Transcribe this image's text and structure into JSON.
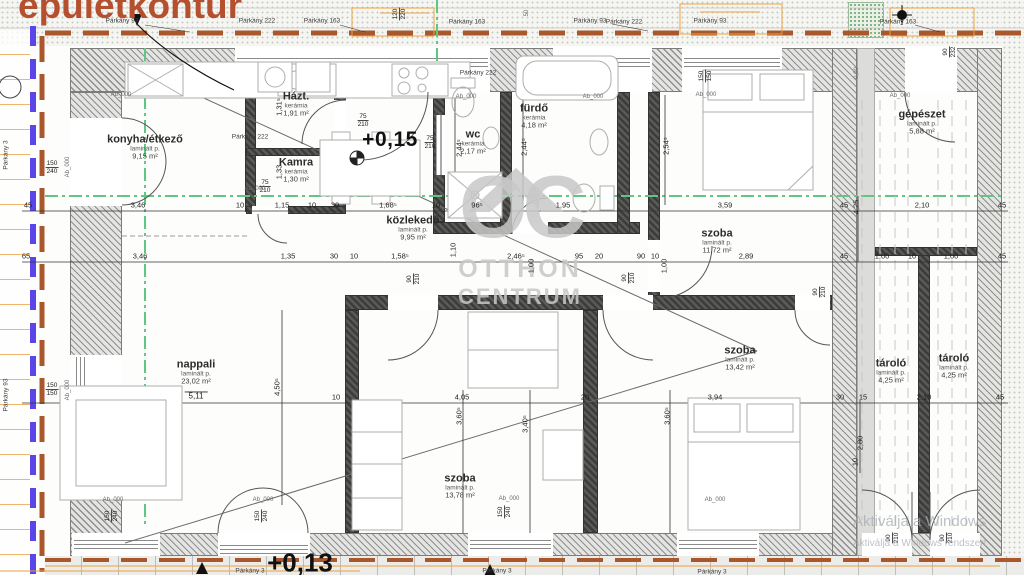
{
  "title": "épületkontúr",
  "watermark": {
    "logo": "OC",
    "line1": "OTTHON",
    "line2": "CENTRUM"
  },
  "windows_watermark": {
    "line1": "Aktiválja a Windows",
    "line2": "Aktiválja a Windows rendszert"
  },
  "colors": {
    "title_red": "#b5502f",
    "contour_brown": "#a9572b",
    "guide_blue": "#5a46e8",
    "guide_green": "#5ec784",
    "construction_orange": "#eba23e",
    "watermark_gray": "#c8c8c8"
  },
  "rooms": [
    {
      "name": "konyha/étkező",
      "mat": "laminált p.",
      "area": "9,15 m²",
      "extra": "",
      "x": 145,
      "y": 147
    },
    {
      "name": "Házt.",
      "mat": "kerámia",
      "area": "1,91 m²",
      "extra": "",
      "x": 296,
      "y": 104
    },
    {
      "name": "Kamra",
      "mat": "kerámia",
      "area": "1,30 m²",
      "extra": "",
      "x": 296,
      "y": 170
    },
    {
      "name": "wc",
      "mat": "kerámia",
      "area": "2,17 m²",
      "extra": "",
      "x": 473,
      "y": 142
    },
    {
      "name": "fürdő",
      "mat": "kerámia",
      "area": "4,18 m²",
      "extra": "",
      "x": 534,
      "y": 116
    },
    {
      "name": "közlekedő",
      "mat": "laminált p.",
      "area": "9,95 m²",
      "extra": "",
      "x": 413,
      "y": 228
    },
    {
      "name": "szoba",
      "mat": "laminált p.",
      "area": "11,72 m²",
      "extra": "",
      "x": 717,
      "y": 241
    },
    {
      "name": "nappali",
      "mat": "laminált p.",
      "area": "23,02 m²",
      "extra": "5,11",
      "x": 196,
      "y": 381
    },
    {
      "name": "szoba",
      "mat": "laminált p.",
      "area": "13,42 m²",
      "extra": "",
      "x": 740,
      "y": 358
    },
    {
      "name": "szoba",
      "mat": "laminált p.",
      "area": "13,78 m²",
      "extra": "",
      "x": 460,
      "y": 486
    },
    {
      "name": "gépészet",
      "mat": "laminált p.",
      "area": "5,88 m²",
      "extra": "",
      "x": 922,
      "y": 122
    },
    {
      "name": "tároló",
      "mat": "laminált p.",
      "area": "4,25 m²",
      "extra": "",
      "x": 891,
      "y": 371
    },
    {
      "name": "tároló",
      "mat": "laminált p.",
      "area": "4,25 m²",
      "extra": "",
      "x": 954,
      "y": 366
    }
  ],
  "labels": [
    {
      "t": "+0,15",
      "x": 390,
      "y": 140,
      "c": "lv"
    },
    {
      "t": "+0,13",
      "x": 300,
      "y": 563,
      "c": "lv2"
    },
    {
      "t": "45",
      "x": 28,
      "y": 205,
      "c": "d"
    },
    {
      "t": "3,46",
      "x": 138,
      "y": 205,
      "c": "d"
    },
    {
      "t": "10",
      "x": 240,
      "y": 205,
      "c": "d"
    },
    {
      "t": "1,15",
      "x": 282,
      "y": 205,
      "c": "d"
    },
    {
      "t": "10",
      "x": 312,
      "y": 205,
      "c": "d"
    },
    {
      "t": "30",
      "x": 335,
      "y": 205,
      "c": "d"
    },
    {
      "t": "1,68⁵",
      "x": 388,
      "y": 205,
      "c": "d"
    },
    {
      "t": "10",
      "x": 436,
      "y": 205,
      "c": "d"
    },
    {
      "t": "96⁵",
      "x": 477,
      "y": 205,
      "c": "d"
    },
    {
      "t": "1,95",
      "x": 563,
      "y": 205,
      "c": "d"
    },
    {
      "t": "3,59",
      "x": 725,
      "y": 205,
      "c": "d"
    },
    {
      "t": "45",
      "x": 844,
      "y": 205,
      "c": "d"
    },
    {
      "t": "2,10",
      "x": 922,
      "y": 205,
      "c": "d"
    },
    {
      "t": "45",
      "x": 1002,
      "y": 205,
      "c": "d"
    },
    {
      "t": "65",
      "x": 26,
      "y": 256,
      "c": "d"
    },
    {
      "t": "3,46",
      "x": 140,
      "y": 256,
      "c": "d"
    },
    {
      "t": "1,35",
      "x": 288,
      "y": 256,
      "c": "d"
    },
    {
      "t": "30",
      "x": 334,
      "y": 256,
      "c": "d"
    },
    {
      "t": "10",
      "x": 354,
      "y": 256,
      "c": "d"
    },
    {
      "t": "1,58⁵",
      "x": 400,
      "y": 256,
      "c": "d"
    },
    {
      "t": "2,46⁵",
      "x": 516,
      "y": 256,
      "c": "d"
    },
    {
      "t": "95",
      "x": 579,
      "y": 256,
      "c": "d"
    },
    {
      "t": "20",
      "x": 599,
      "y": 256,
      "c": "d"
    },
    {
      "t": "90",
      "x": 641,
      "y": 256,
      "c": "d"
    },
    {
      "t": "10",
      "x": 655,
      "y": 256,
      "c": "d"
    },
    {
      "t": "2,89",
      "x": 746,
      "y": 256,
      "c": "d"
    },
    {
      "t": "45",
      "x": 844,
      "y": 256,
      "c": "d"
    },
    {
      "t": "1,00",
      "x": 882,
      "y": 256,
      "c": "d"
    },
    {
      "t": "10",
      "x": 912,
      "y": 256,
      "c": "d"
    },
    {
      "t": "1,00",
      "x": 951,
      "y": 256,
      "c": "d"
    },
    {
      "t": "45",
      "x": 1002,
      "y": 256,
      "c": "d"
    },
    {
      "t": "10",
      "x": 336,
      "y": 397,
      "c": "d"
    },
    {
      "t": "4,05",
      "x": 462,
      "y": 397,
      "c": "d"
    },
    {
      "t": "20",
      "x": 585,
      "y": 397,
      "c": "d"
    },
    {
      "t": "3,94",
      "x": 715,
      "y": 397,
      "c": "d"
    },
    {
      "t": "30",
      "x": 840,
      "y": 397,
      "c": "d"
    },
    {
      "t": "15",
      "x": 863,
      "y": 397,
      "c": "d"
    },
    {
      "t": "2,10",
      "x": 924,
      "y": 397,
      "c": "d"
    },
    {
      "t": "45",
      "x": 1000,
      "y": 397,
      "c": "d"
    },
    {
      "t": "1,31⁵",
      "x": 279,
      "y": 107,
      "c": "dv"
    },
    {
      "t": "1,33",
      "x": 279,
      "y": 172,
      "c": "dv"
    },
    {
      "t": "2,44⁵",
      "x": 459,
      "y": 148,
      "c": "dv"
    },
    {
      "t": "2,44⁵",
      "x": 524,
      "y": 147,
      "c": "dv"
    },
    {
      "t": "2,54⁵",
      "x": 666,
      "y": 146,
      "c": "dv"
    },
    {
      "t": "1,10",
      "x": 453,
      "y": 250,
      "c": "dv"
    },
    {
      "t": "1,00",
      "x": 531,
      "y": 266,
      "c": "dv"
    },
    {
      "t": "1,00",
      "x": 664,
      "y": 266,
      "c": "dv"
    },
    {
      "t": "4,50⁵",
      "x": 277,
      "y": 387,
      "c": "dv"
    },
    {
      "t": "3,60⁵",
      "x": 459,
      "y": 416,
      "c": "dv"
    },
    {
      "t": "3,40⁵",
      "x": 525,
      "y": 424,
      "c": "dv"
    },
    {
      "t": "3,60⁵",
      "x": 667,
      "y": 416,
      "c": "dv"
    },
    {
      "t": "2,80",
      "x": 860,
      "y": 443,
      "c": "dv"
    },
    {
      "t": "4,25",
      "x": 856,
      "y": 207,
      "c": "dv"
    },
    {
      "t": "10",
      "x": 855,
      "y": 462,
      "c": "dv"
    },
    {
      "t": "0,00",
      "x": 857,
      "y": 73,
      "c": "tv"
    },
    {
      "t": "50",
      "x": 527,
      "y": 13,
      "c": "tv"
    },
    {
      "t": "Ab_000",
      "x": 68,
      "y": 167,
      "c": "tv"
    },
    {
      "t": "Ab_000",
      "x": 68,
      "y": 390,
      "c": "tv"
    },
    {
      "t": "75|210",
      "x": 363,
      "y": 121,
      "c": "f"
    },
    {
      "t": "75|210",
      "x": 430,
      "y": 143,
      "c": "f"
    },
    {
      "t": "75|210",
      "x": 265,
      "y": 187,
      "c": "f"
    },
    {
      "t": "150|240",
      "x": 52,
      "y": 168,
      "c": "f"
    },
    {
      "t": "150|150",
      "x": 52,
      "y": 390,
      "c": "f"
    },
    {
      "t": "90|232",
      "x": 950,
      "y": 52,
      "c": "fv"
    },
    {
      "t": "90|210",
      "x": 414,
      "y": 279,
      "c": "fv"
    },
    {
      "t": "90|210",
      "x": 629,
      "y": 278,
      "c": "fv"
    },
    {
      "t": "90|210",
      "x": 820,
      "y": 292,
      "c": "fv"
    },
    {
      "t": "90|210",
      "x": 893,
      "y": 538,
      "c": "fv"
    },
    {
      "t": "90|210",
      "x": 947,
      "y": 538,
      "c": "fv"
    },
    {
      "t": "150|150",
      "x": 706,
      "y": 76,
      "c": "fv"
    },
    {
      "t": "120|220",
      "x": 400,
      "y": 14,
      "c": "fv"
    },
    {
      "t": "150|240",
      "x": 112,
      "y": 516,
      "c": "fv"
    },
    {
      "t": "150|240",
      "x": 262,
      "y": 516,
      "c": "fv"
    },
    {
      "t": "150|240",
      "x": 505,
      "y": 512,
      "c": "fv"
    },
    {
      "t": "Ab_000",
      "x": 121,
      "y": 95,
      "c": "t"
    },
    {
      "t": "Ab_000",
      "x": 466,
      "y": 97,
      "c": "t"
    },
    {
      "t": "Ab_000",
      "x": 593,
      "y": 97,
      "c": "t"
    },
    {
      "t": "Ab_000",
      "x": 706,
      "y": 95,
      "c": "t"
    },
    {
      "t": "Ab_000",
      "x": 900,
      "y": 96,
      "c": "t"
    },
    {
      "t": "Ab_000",
      "x": 255,
      "y": 189,
      "c": "t"
    },
    {
      "t": "Ab_000",
      "x": 113,
      "y": 500,
      "c": "t"
    },
    {
      "t": "Ab_000",
      "x": 263,
      "y": 500,
      "c": "t"
    },
    {
      "t": "Ab_000",
      "x": 509,
      "y": 499,
      "c": "t"
    },
    {
      "t": "Ab_000",
      "x": 715,
      "y": 500,
      "c": "t"
    },
    {
      "t": "Párkány 93",
      "x": 122,
      "y": 21,
      "c": "p"
    },
    {
      "t": "Párkány 222",
      "x": 257,
      "y": 21,
      "c": "p"
    },
    {
      "t": "Párkány 163",
      "x": 322,
      "y": 21,
      "c": "p"
    },
    {
      "t": "Párkány 163",
      "x": 467,
      "y": 22,
      "c": "p"
    },
    {
      "t": "Párkány 93",
      "x": 590,
      "y": 21,
      "c": "p"
    },
    {
      "t": "Párkány 222",
      "x": 624,
      "y": 22,
      "c": "p"
    },
    {
      "t": "Párkány 93",
      "x": 710,
      "y": 21,
      "c": "p"
    },
    {
      "t": "Párkány 163",
      "x": 898,
      "y": 22,
      "c": "p"
    },
    {
      "t": "Párkány 222",
      "x": 478,
      "y": 73,
      "c": "p"
    },
    {
      "t": "Párkány 222",
      "x": 250,
      "y": 137,
      "c": "p"
    },
    {
      "t": "Párkány 3",
      "x": 6,
      "y": 155,
      "c": "pv"
    },
    {
      "t": "Párkány 93",
      "x": 6,
      "y": 395,
      "c": "pv"
    },
    {
      "t": "Párkány 3",
      "x": 250,
      "y": 571,
      "c": "p"
    },
    {
      "t": "Párkány 3",
      "x": 497,
      "y": 571,
      "c": "p"
    },
    {
      "t": "Párkány 3",
      "x": 712,
      "y": 572,
      "c": "p"
    }
  ]
}
